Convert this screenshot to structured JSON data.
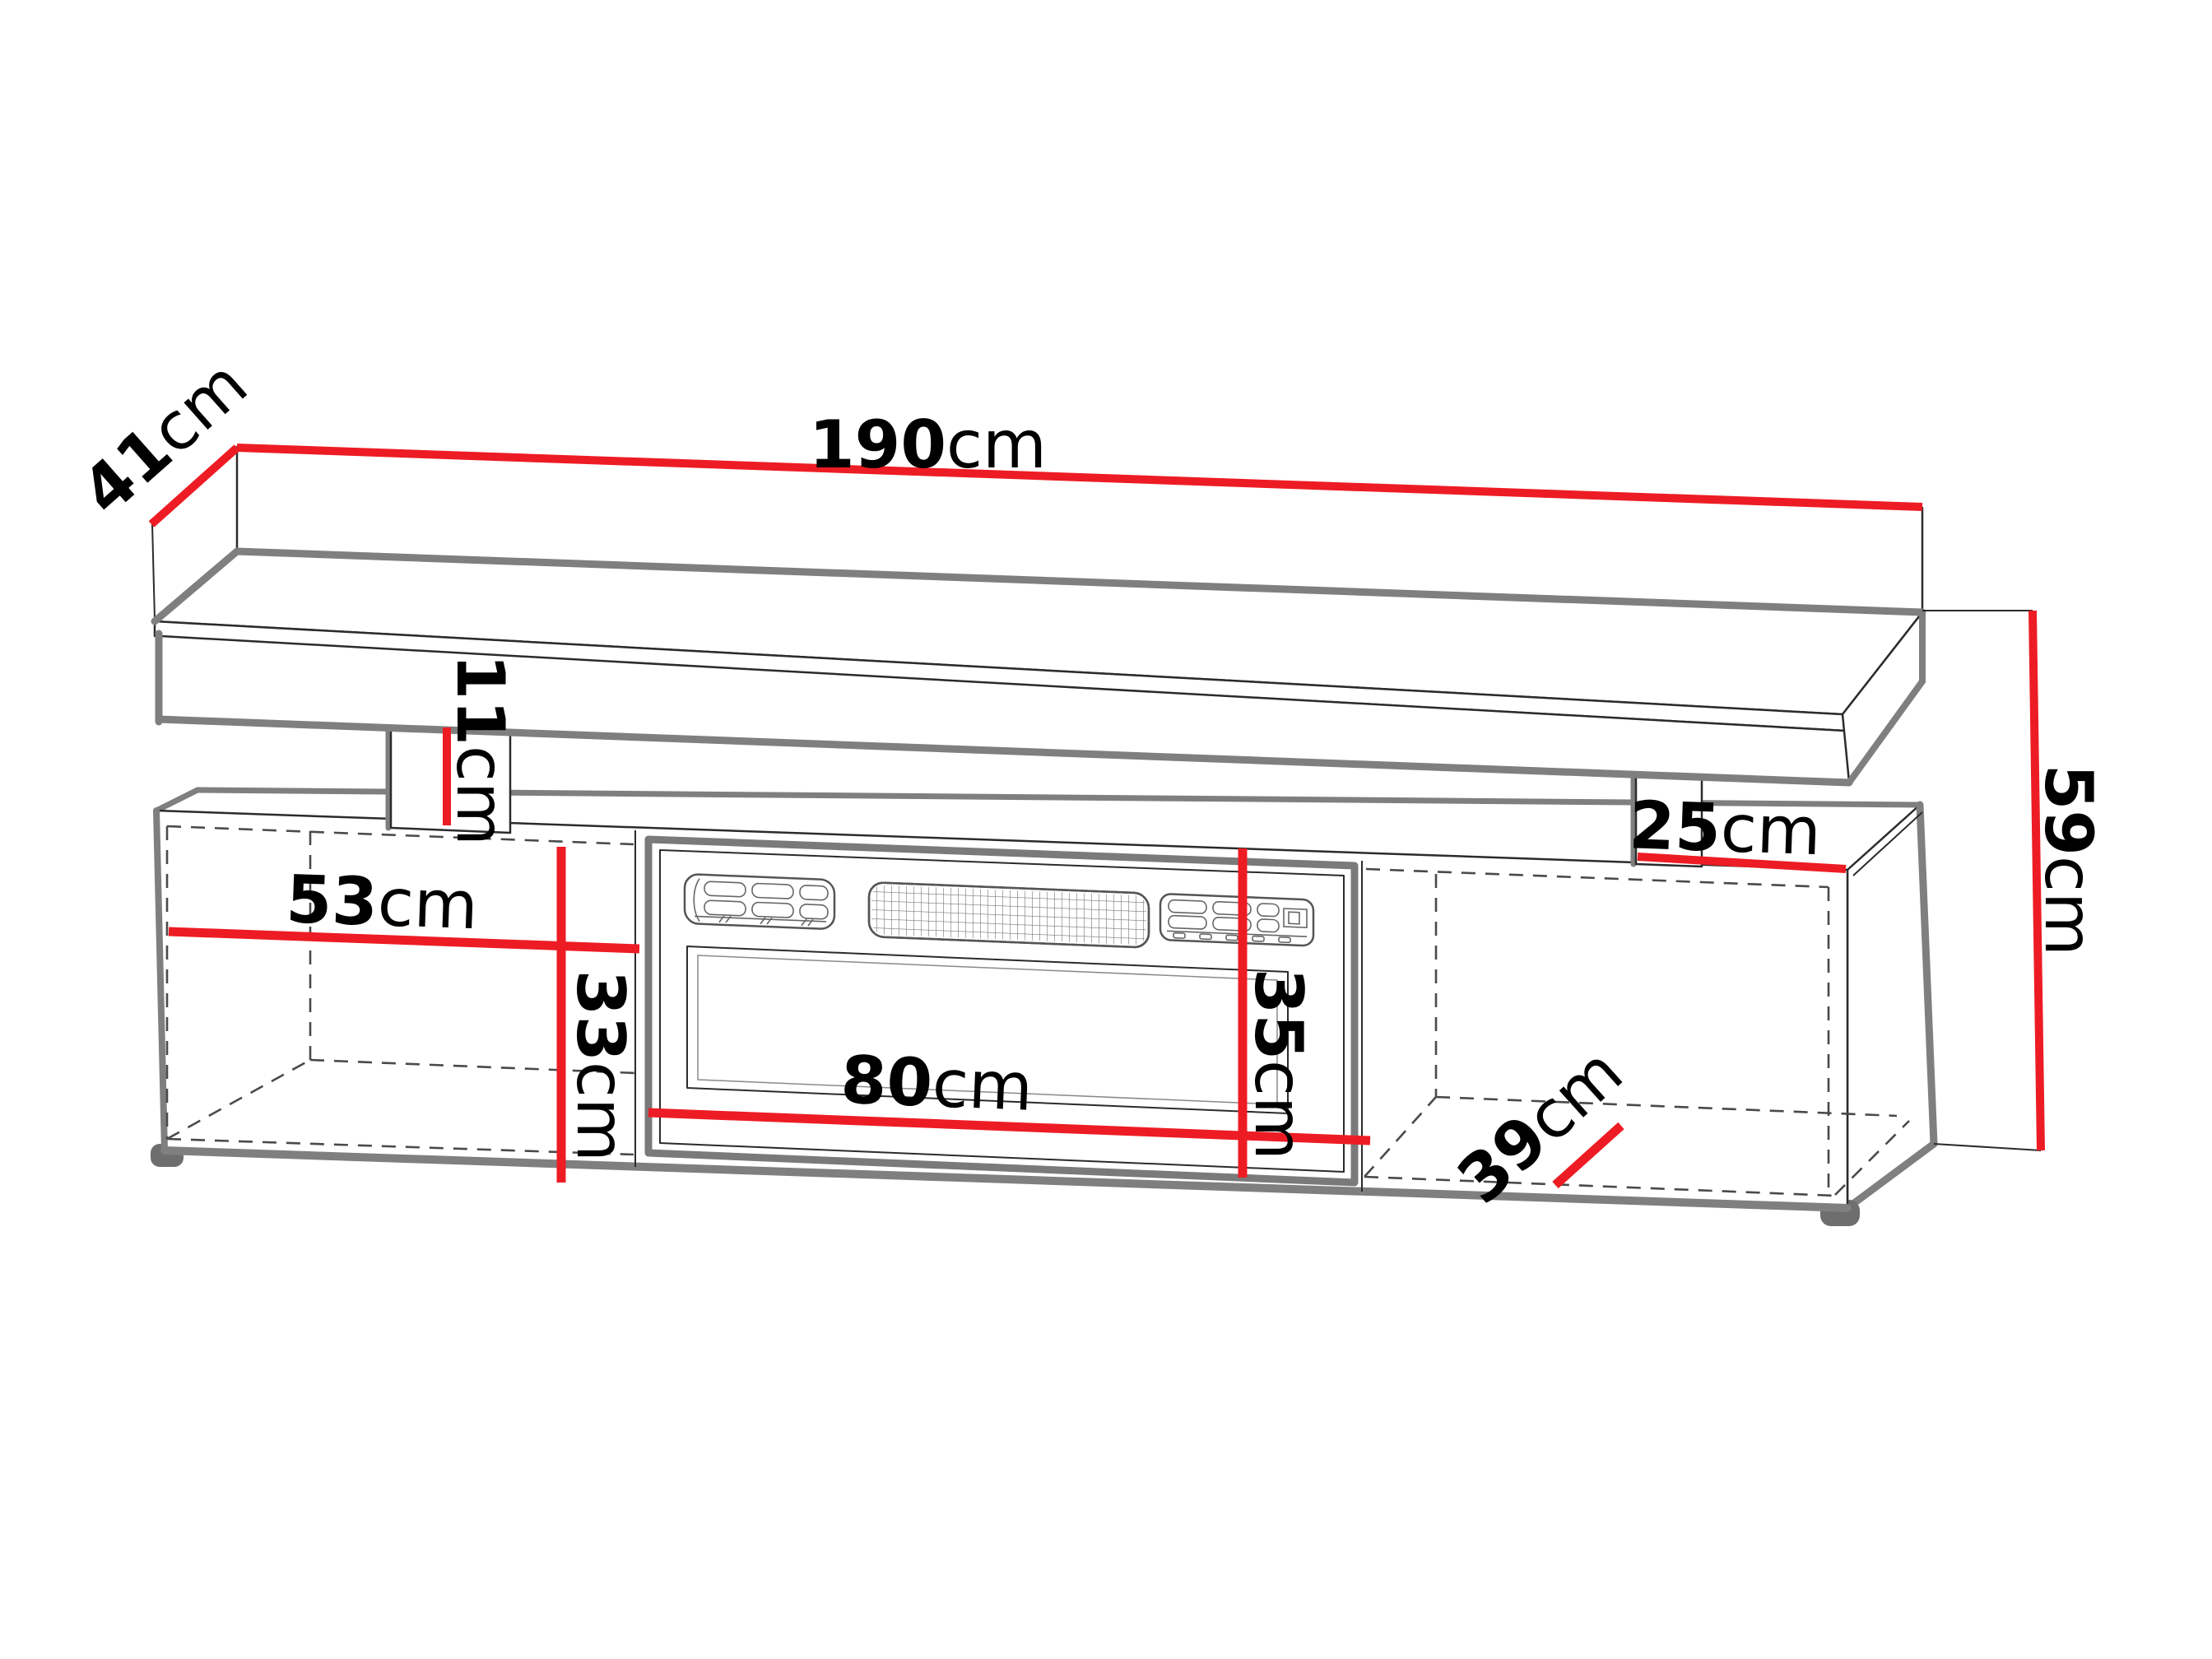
{
  "diagram": {
    "title": "TV stand with electric fireplace - dimension drawing",
    "colors": {
      "dimension_line": "#ed1c24",
      "outline": "#2b2b2b",
      "shadow_edge": "#7f7f7f",
      "hidden_edge": "#4a4a4a",
      "background": "#ffffff",
      "label_text": "#000000"
    },
    "dimensions": {
      "top_width": {
        "value": "190",
        "unit": "cm"
      },
      "top_depth": {
        "value": "41",
        "unit": "cm"
      },
      "total_height": {
        "value": "59",
        "unit": "cm"
      },
      "gap_height": {
        "value": "11",
        "unit": "cm"
      },
      "left_width": {
        "value": "53",
        "unit": "cm"
      },
      "left_height": {
        "value": "33",
        "unit": "cm"
      },
      "fireplace_width": {
        "value": "80",
        "unit": "cm"
      },
      "fireplace_height": {
        "value": "35",
        "unit": "cm"
      },
      "top_right_depth": {
        "value": "25",
        "unit": "cm"
      },
      "right_depth": {
        "value": "39",
        "unit": "cm"
      }
    }
  }
}
